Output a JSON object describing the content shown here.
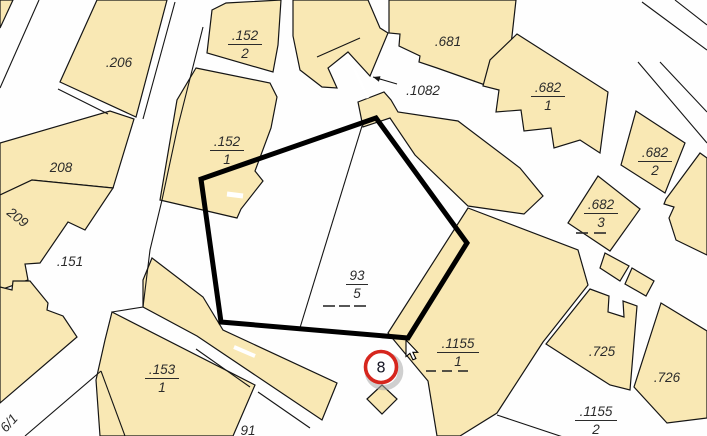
{
  "map": {
    "canvas": {
      "width": 707,
      "height": 436
    },
    "colors": {
      "background": "#fefefe",
      "parcel_fill": "#F9E8B4",
      "boundary": "#151515",
      "label": "#2b2b2b",
      "selection": "#000000",
      "marker_ring": "#D6261E",
      "marker_fill": "#ffffff",
      "marker_shadow": "#a8a8a8",
      "cursor_fill": "#ffffff"
    },
    "parcels": [
      {
        "id": "corner-sliver",
        "points": "0,0 13,0 0,28"
      },
      {
        "id": "206",
        "points": "97,0 167,0 136,117 60,82"
      },
      {
        "id": "208",
        "points": "0,143 110,111 134,119 113,188 32,180 0,195"
      },
      {
        "id": "209",
        "points": "0,195 32,180 113,188 85,230 68,222 40,263 25,264 28,280 0,290"
      },
      {
        "id": "left-wedge",
        "points": "0,287 12,290 13,281 30,281 48,303 47,310 63,316 77,337 0,403"
      },
      {
        "id": "152-2",
        "points": "226,3 281,0 278,45 273,72 207,53 212,10"
      },
      {
        "id": "152-1",
        "points": "196,68 270,83 277,97 271,128 255,171 263,181 241,209 237,218 160,200 177,100"
      },
      {
        "id": "top-mass",
        "points": "293,0 368,0 380,28 388,33 370,76 348,52 328,68 337,88 322,87 300,70 293,36"
      },
      {
        "id": "681",
        "points": "389,0 516,0 512,36 505,92 437,68 419,62 420,56 399,46 400,34 389,33"
      },
      {
        "id": "682-1",
        "points": "517,34 608,92 600,153 580,140 554,148 551,128 524,131 521,110 496,112 499,90 483,86 490,60"
      },
      {
        "id": "682-2",
        "points": "636,111 685,143 665,193 621,165"
      },
      {
        "id": "right-edge-upper",
        "points": "666,199 700,153 707,158 707,255 676,240 669,218 674,207 664,204"
      },
      {
        "id": "682-3",
        "points": "568,223 598,176 640,209 610,251"
      },
      {
        "id": "mid-small-1",
        "points": "605,253 629,266 620,281 600,268"
      },
      {
        "id": "mid-small-2",
        "points": "632,268 654,281 646,296 625,284"
      },
      {
        "id": "band-1082",
        "points": "358,102 384,92 391,100 398,112 458,121 520,168 543,196 524,214 468,206 415,155 390,118 363,127"
      },
      {
        "id": "1155-1",
        "points": "468,208 578,250 588,285 543,342 497,413 460,436 437,436 428,381 388,333"
      },
      {
        "id": "725",
        "points": "590,289 609,296 608,312 624,317 623,301 637,306 630,390 610,385 546,344"
      },
      {
        "id": "726",
        "points": "661,303 707,331 707,418 667,423 634,387"
      },
      {
        "id": "strip-a",
        "points": "152,258 203,297 223,330 337,383 322,420 197,336 143,307 143,280"
      },
      {
        "id": "153-1",
        "points": "112,312 255,385 233,436 100,436 96,380 105,340"
      },
      {
        "id": "small-diamond",
        "points": "367,399 382,385 397,399 382,414"
      }
    ],
    "boundary_lines": [
      {
        "points": "317,57 360,38"
      },
      {
        "points": "175,2 143,119"
      },
      {
        "points": "58,89 108,114"
      },
      {
        "points": "39,0 0,88"
      },
      {
        "points": "203,27 177,130 162,200 150,250 143,307 112,312"
      },
      {
        "points": "101,371 25,436"
      },
      {
        "points": "101,371 125,436"
      },
      {
        "points": "196,349 250,387"
      },
      {
        "points": "258,392 310,428"
      },
      {
        "points": "362,126 299,331"
      },
      {
        "points": "497,415 563,437"
      },
      {
        "points": "642,2 707,50"
      },
      {
        "points": "675,0 707,25"
      },
      {
        "points": "638,62 707,143"
      },
      {
        "points": "660,62 707,112"
      }
    ],
    "white_slots": [
      {
        "points": "347,54 368,98",
        "w": 3
      },
      {
        "points": "227,194 243,196",
        "w": 5
      },
      {
        "points": "234,347 255,356",
        "w": 4
      }
    ],
    "labels": [
      {
        "text": ".206",
        "x": 119,
        "y": 67
      },
      {
        "text": ".681",
        "x": 448,
        "y": 46
      },
      {
        "text": ".1082",
        "x": 423,
        "y": 95
      },
      {
        "text": "208",
        "x": 61,
        "y": 172
      },
      {
        "text": ".151",
        "x": 70,
        "y": 266
      },
      {
        "text": ".725",
        "x": 602,
        "y": 356
      },
      {
        "text": ".726",
        "x": 667,
        "y": 382
      },
      {
        "text": "91",
        "x": 248,
        "y": 435
      },
      {
        "text": "209",
        "x": 6,
        "y": 214,
        "rotate": 38
      },
      {
        "text": "6/1",
        "x": 6,
        "y": 433,
        "rotate": -48
      }
    ],
    "fraction_labels": [
      {
        "top": ".152",
        "bottom": "2",
        "x": 245,
        "y": 40,
        "lw": 17
      },
      {
        "top": ".152",
        "bottom": "1",
        "x": 227,
        "y": 146,
        "lw": 17
      },
      {
        "top": ".682",
        "bottom": "1",
        "x": 548,
        "y": 92,
        "lw": 17
      },
      {
        "top": ".682",
        "bottom": "2",
        "x": 655,
        "y": 157,
        "lw": 17
      },
      {
        "top": ".682",
        "bottom": "3",
        "x": 601,
        "y": 209,
        "lw": 17
      },
      {
        "top": "93",
        "bottom": "5",
        "x": 357,
        "y": 280,
        "lw": 11
      },
      {
        "top": ".1155",
        "bottom": "1",
        "x": 458,
        "y": 348,
        "lw": 21
      },
      {
        "top": ".153",
        "bottom": "1",
        "x": 162,
        "y": 374,
        "lw": 17
      },
      {
        "top": ".1155",
        "bottom": "2",
        "x": 596,
        "y": 416,
        "lw": 21
      }
    ],
    "dash_groups": [
      {
        "y": 233,
        "segs": [
          [
            576,
            588
          ],
          [
            594,
            606
          ]
        ]
      },
      {
        "y": 306,
        "segs": [
          [
            323,
            335
          ],
          [
            339,
            350
          ],
          [
            354,
            366
          ]
        ]
      },
      {
        "y": 371,
        "segs": [
          [
            426,
            436
          ],
          [
            442,
            452
          ],
          [
            458,
            468
          ]
        ]
      }
    ],
    "selection": {
      "points": "376,118 467,243 408,338 221,322 201,179",
      "width": 5
    },
    "annotation_arrow": {
      "line": [
        397,
        84,
        373,
        77
      ],
      "head_points": "373,77 380.5,76.3 378.9,81.7"
    },
    "marker": {
      "label": "8",
      "x": 381,
      "y": 367,
      "r": 15.5,
      "ring_w": 3.6,
      "font_size": 15
    },
    "cursor": {
      "x": 406,
      "y": 340,
      "shape": "0,0 0,16.5 3.9,13.4 6.9,19.8 9.9,18.6 6.9,12.3 11.7,12.3"
    }
  }
}
